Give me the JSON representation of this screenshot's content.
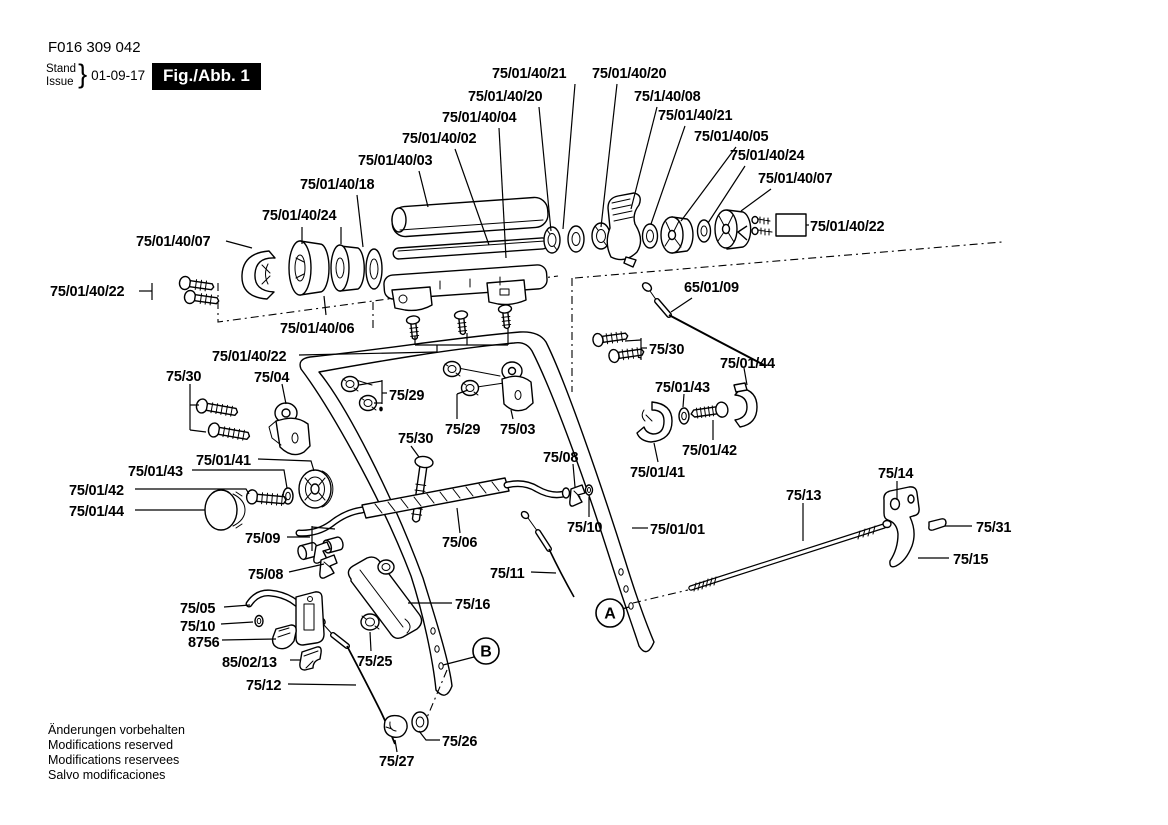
{
  "header": {
    "doc_number": "F016 309 042",
    "stand": "Stand",
    "issue": "Issue",
    "brace": "}",
    "date": "01-09-17",
    "figure_label": "Fig./Abb. 1"
  },
  "footer": {
    "lines": [
      "Änderungen vorbehalten",
      "Modifications reserved",
      "Modifications reservees",
      "Salvo modificaciones"
    ]
  },
  "diagram": {
    "ink": "#000000",
    "markers": [
      {
        "letter": "A",
        "cx": 610,
        "cy": 613,
        "r": 14,
        "line": [
          [
            622,
            609
          ],
          [
            629,
            607
          ]
        ]
      },
      {
        "letter": "B",
        "cx": 486,
        "cy": 651,
        "r": 13,
        "line": [
          [
            474,
            657
          ],
          [
            443,
            665
          ]
        ]
      }
    ],
    "labels": [
      {
        "t": "75/01/40/21",
        "x": 492,
        "y": 78,
        "ld": [
          [
            [
              575,
              84
            ],
            [
              563,
              229
            ]
          ]
        ]
      },
      {
        "t": "75/01/40/20",
        "x": 592,
        "y": 78,
        "ld": [
          [
            [
              617,
              84
            ],
            [
              601,
              227
            ]
          ]
        ]
      },
      {
        "t": "75/01/40/20",
        "x": 468,
        "y": 101,
        "ld": [
          [
            [
              539,
              107
            ],
            [
              551,
              231
            ]
          ]
        ]
      },
      {
        "t": "75/1/40/08",
        "x": 634,
        "y": 101,
        "ld": [
          [
            [
              657,
              107
            ],
            [
              631,
              209
            ]
          ]
        ]
      },
      {
        "t": "75/01/40/04",
        "x": 442,
        "y": 122,
        "ld": [
          [
            [
              499,
              128
            ],
            [
              506,
              258
            ]
          ]
        ]
      },
      {
        "t": "75/01/40/21",
        "x": 658,
        "y": 120,
        "ld": [
          [
            [
              685,
              126
            ],
            [
              651,
              224
            ]
          ]
        ]
      },
      {
        "t": "75/01/40/02",
        "x": 402,
        "y": 143,
        "ld": [
          [
            [
              455,
              149
            ],
            [
              489,
              245
            ]
          ]
        ]
      },
      {
        "t": "75/01/40/05",
        "x": 694,
        "y": 141,
        "ld": [
          [
            [
              736,
              147
            ],
            [
              681,
              221
            ]
          ]
        ]
      },
      {
        "t": "75/01/40/03",
        "x": 358,
        "y": 165,
        "ld": [
          [
            [
              419,
              171
            ],
            [
              428,
              207
            ]
          ]
        ]
      },
      {
        "t": "75/01/40/24",
        "x": 730,
        "y": 160,
        "ld": [
          [
            [
              745,
              166
            ],
            [
              708,
              223
            ]
          ]
        ]
      },
      {
        "t": "75/01/40/18",
        "x": 300,
        "y": 189,
        "ld": [
          [
            [
              357,
              195
            ],
            [
              363,
              247
            ]
          ]
        ]
      },
      {
        "t": "75/01/40/07",
        "x": 758,
        "y": 183,
        "ld": [
          [
            [
              771,
              189
            ],
            [
              741,
              211
            ]
          ]
        ]
      },
      {
        "t": "75/01/40/24",
        "x": 262,
        "y": 220,
        "ld": [
          [
            [
              302,
              227
            ],
            [
              302,
              244
            ]
          ],
          [
            [
              341,
              227
            ],
            [
              341,
              244
            ]
          ]
        ]
      },
      {
        "t": "75/01/40/22",
        "x": 810,
        "y": 231,
        "ld": [
          [
            [
              806,
              225
            ],
            [
              809,
              225
            ]
          ]
        ]
      },
      {
        "t": "75/01/40/07",
        "x": 136,
        "y": 246,
        "ld": [
          [
            [
              226,
              241
            ],
            [
              252,
              248
            ]
          ]
        ]
      },
      {
        "t": "75/01/40/22",
        "x": 50,
        "y": 296,
        "ld": [
          [
            [
              139,
              291
            ],
            [
              152,
              291
            ]
          ],
          [
            [
              152,
              283
            ],
            [
              152,
              300
            ]
          ]
        ]
      },
      {
        "t": "75/01/40/06",
        "x": 280,
        "y": 333,
        "ld": [
          [
            [
              326,
              315
            ],
            [
              324,
              296
            ]
          ]
        ]
      },
      {
        "t": "65/01/09",
        "x": 684,
        "y": 292,
        "ld": [
          [
            [
              692,
              298
            ],
            [
              671,
              312
            ]
          ]
        ]
      },
      {
        "t": "75/01/40/22",
        "x": 212,
        "y": 361,
        "ld": [
          [
            [
              299,
              355
            ],
            [
              437,
              352
            ]
          ],
          [
            [
              437,
              352
            ],
            [
              437,
              345
            ]
          ],
          [
            [
              415,
              345
            ],
            [
              508,
              345
            ]
          ],
          [
            [
              415,
              345
            ],
            [
              415,
              336
            ]
          ],
          [
            [
              467,
              345
            ],
            [
              467,
              333
            ]
          ],
          [
            [
              508,
              345
            ],
            [
              508,
              328
            ]
          ]
        ]
      },
      {
        "t": "75/30",
        "x": 166,
        "y": 381,
        "ld": [
          [
            [
              190,
              384
            ],
            [
              190,
              430
            ]
          ],
          [
            [
              190,
              405
            ],
            [
              199,
              405
            ]
          ],
          [
            [
              190,
              430
            ],
            [
              206,
              432
            ]
          ]
        ]
      },
      {
        "t": "75/04",
        "x": 254,
        "y": 382,
        "ld": [
          [
            [
              282,
              384
            ],
            [
              286,
              404
            ]
          ]
        ]
      },
      {
        "t": "75/29",
        "x": 389,
        "y": 400,
        "ld": [
          [
            [
              387,
              393
            ],
            [
              382,
              393
            ]
          ],
          [
            [
              382,
              380
            ],
            [
              382,
              404
            ]
          ],
          [
            [
              382,
              381
            ],
            [
              359,
              385
            ]
          ],
          [
            [
              382,
              403
            ],
            [
              374,
              403
            ]
          ]
        ]
      },
      {
        "t": "75/30",
        "x": 649,
        "y": 354,
        "ld": [
          [
            [
              647,
              348
            ],
            [
              641,
              348
            ]
          ],
          [
            [
              641,
              338
            ],
            [
              641,
              360
            ]
          ],
          [
            [
              641,
              340
            ],
            [
              625,
              341
            ]
          ],
          [
            [
              641,
              358
            ],
            [
              638,
              357
            ]
          ]
        ]
      },
      {
        "t": "75/01/44",
        "x": 720,
        "y": 368,
        "ld": [
          [
            [
              744,
              368
            ],
            [
              747,
              385
            ]
          ]
        ]
      },
      {
        "t": "75/01/43",
        "x": 655,
        "y": 392,
        "ld": [
          [
            [
              684,
              394
            ],
            [
              683,
              407
            ]
          ]
        ]
      },
      {
        "t": "75/29",
        "x": 445,
        "y": 434,
        "ld": [
          [
            [
              457,
              419
            ],
            [
              457,
              394
            ]
          ],
          [
            [
              457,
              394
            ],
            [
              468,
              390
            ]
          ]
        ]
      },
      {
        "t": "75/03",
        "x": 500,
        "y": 434,
        "ld": [
          [
            [
              513,
              419
            ],
            [
              511,
              410
            ]
          ]
        ]
      },
      {
        "t": "75/30",
        "x": 398,
        "y": 443,
        "ld": [
          [
            [
              411,
              446
            ],
            [
              419,
              457
            ]
          ]
        ]
      },
      {
        "t": "75/01/42",
        "x": 682,
        "y": 455,
        "ld": [
          [
            [
              713,
              440
            ],
            [
              713,
              420
            ]
          ]
        ]
      },
      {
        "t": "75/01/41",
        "x": 630,
        "y": 477,
        "ld": [
          [
            [
              658,
              462
            ],
            [
              654,
              443
            ]
          ]
        ]
      },
      {
        "t": "75/01/43",
        "x": 128,
        "y": 476,
        "ld": [
          [
            [
              192,
              470
            ],
            [
              284,
              470
            ],
            [
              287,
              488
            ]
          ]
        ]
      },
      {
        "t": "75/01/41",
        "x": 196,
        "y": 465,
        "ld": [
          [
            [
              258,
              459
            ],
            [
              311,
              461
            ],
            [
              314,
              471
            ]
          ]
        ]
      },
      {
        "t": "75/01/42",
        "x": 69,
        "y": 495,
        "ld": [
          [
            [
              135,
              489
            ],
            [
              246,
              489
            ],
            [
              249,
              494
            ]
          ]
        ]
      },
      {
        "t": "75/01/44",
        "x": 69,
        "y": 516,
        "ld": [
          [
            [
              135,
              510
            ],
            [
              205,
              510
            ]
          ]
        ]
      },
      {
        "t": "75/09",
        "x": 245,
        "y": 543,
        "ld": [
          [
            [
              287,
              537
            ],
            [
              310,
              537
            ]
          ],
          [
            [
              312,
              526
            ],
            [
              312,
              551
            ]
          ],
          [
            [
              312,
              527
            ],
            [
              335,
              529
            ]
          ]
        ]
      },
      {
        "t": "75/08",
        "x": 248,
        "y": 579,
        "ld": [
          [
            [
              289,
              572
            ],
            [
              324,
              564
            ]
          ]
        ]
      },
      {
        "t": "75/05",
        "x": 180,
        "y": 613,
        "ld": [
          [
            [
              224,
              607
            ],
            [
              250,
              605
            ]
          ]
        ]
      },
      {
        "t": "75/10",
        "x": 180,
        "y": 631,
        "ld": [
          [
            [
              221,
              624
            ],
            [
              253,
              622
            ]
          ]
        ]
      },
      {
        "t": "8756",
        "x": 188,
        "y": 647,
        "ld": [
          [
            [
              222,
              640
            ],
            [
              276,
              639
            ]
          ]
        ]
      },
      {
        "t": "85/02/13",
        "x": 222,
        "y": 667,
        "ld": [
          [
            [
              290,
              660
            ],
            [
              301,
              660
            ]
          ]
        ]
      },
      {
        "t": "75/12",
        "x": 246,
        "y": 690,
        "ld": [
          [
            [
              288,
              684
            ],
            [
              356,
              685
            ]
          ]
        ]
      },
      {
        "t": "75/25",
        "x": 357,
        "y": 666,
        "ld": [
          [
            [
              371,
              651
            ],
            [
              370,
              632
            ]
          ]
        ]
      },
      {
        "t": "75/16",
        "x": 455,
        "y": 609,
        "ld": [
          [
            [
              452,
              603
            ],
            [
              408,
              603
            ]
          ]
        ]
      },
      {
        "t": "75/11",
        "x": 490,
        "y": 578,
        "ld": [
          [
            [
              531,
              572
            ],
            [
              556,
              573
            ]
          ]
        ]
      },
      {
        "t": "75/26",
        "x": 442,
        "y": 746,
        "ld": [
          [
            [
              440,
              740
            ],
            [
              426,
              740
            ],
            [
              419,
              731
            ]
          ]
        ]
      },
      {
        "t": "75/27",
        "x": 379,
        "y": 766,
        "ld": [
          [
            [
              397,
              752
            ],
            [
              395,
              740
            ]
          ]
        ]
      },
      {
        "t": "75/08",
        "x": 543,
        "y": 462,
        "ld": [
          [
            [
              573,
              464
            ],
            [
              575,
              487
            ]
          ]
        ]
      },
      {
        "t": "75/10",
        "x": 567,
        "y": 532,
        "ld": [
          [
            [
              589,
              517
            ],
            [
              589,
              497
            ]
          ]
        ]
      },
      {
        "t": "75/01/01",
        "x": 650,
        "y": 534,
        "ld": [
          [
            [
              648,
              528
            ],
            [
              632,
              528
            ]
          ]
        ]
      },
      {
        "t": "75/13",
        "x": 786,
        "y": 500,
        "ld": [
          [
            [
              803,
              503
            ],
            [
              803,
              541
            ]
          ]
        ]
      },
      {
        "t": "75/14",
        "x": 878,
        "y": 478,
        "ld": [
          [
            [
              897,
              481
            ],
            [
              897,
              500
            ]
          ]
        ]
      },
      {
        "t": "75/31",
        "x": 976,
        "y": 532,
        "ld": [
          [
            [
              972,
              526
            ],
            [
              945,
              526
            ]
          ]
        ]
      },
      {
        "t": "75/15",
        "x": 953,
        "y": 564,
        "ld": [
          [
            [
              949,
              558
            ],
            [
              918,
              558
            ]
          ]
        ]
      },
      {
        "t": "75/06",
        "x": 442,
        "y": 547,
        "ld": [
          [
            [
              460,
              533
            ],
            [
              457,
              508
            ]
          ]
        ]
      }
    ]
  }
}
